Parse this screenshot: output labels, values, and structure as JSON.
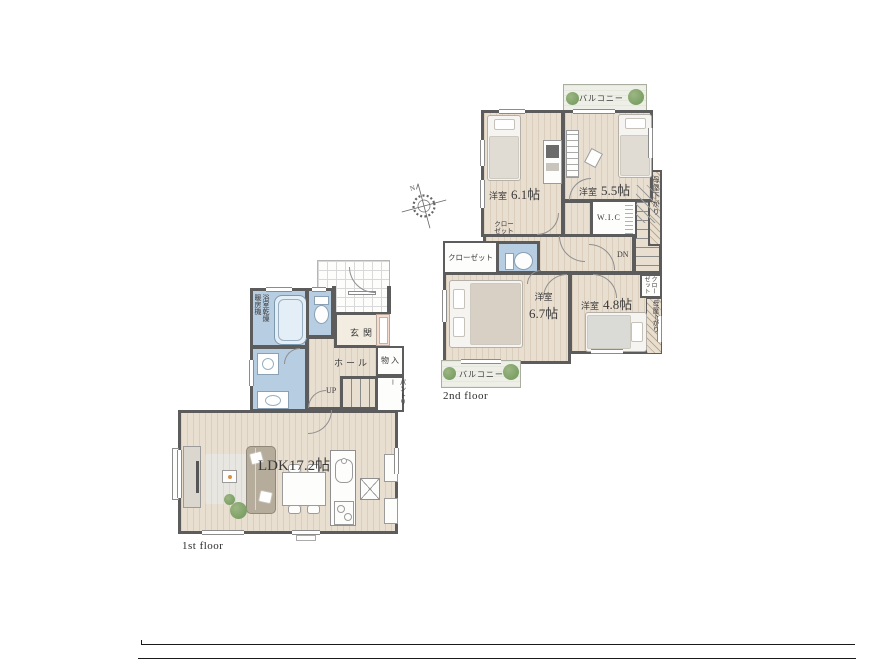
{
  "compass": {
    "north": "N"
  },
  "floor2": {
    "caption": "2nd floor",
    "balcony_top": "バルコニー",
    "balcony_bottom": "バルコニー",
    "bedroom_61_type": "洋室",
    "bedroom_61_size": "6.1帖",
    "bedroom_55_type": "洋室",
    "bedroom_55_size": "5.5帖",
    "bedroom_67_type": "洋室",
    "bedroom_67_size": "6.7帖",
    "bedroom_48_type": "洋室",
    "bedroom_48_size": "4.8帖",
    "wic": "W.I.C",
    "closet_61_line1": "クロー",
    "closet_61_line2": "ゼット",
    "closet_hall": "クローゼット",
    "closet_48_col1": "クロー",
    "closet_48_col2": "ゼット",
    "moya_upper": "母屋下がり",
    "moya_lower": "母屋下がり",
    "stairs_down": "DN"
  },
  "floor1": {
    "caption": "1st floor",
    "ldk": "LDK17.2帖",
    "entrance": "玄関",
    "hall": "ホール",
    "storage": "物入",
    "pantry": "パントリー",
    "stairs_up": "UP",
    "bathroom_dryer_col1": "浴室乾燥",
    "bathroom_dryer_col2": "暖房機"
  },
  "colors": {
    "wall": "#5c5c5c",
    "wood_floor": "#e9dfd1",
    "wet_area": "#b7cde1",
    "tile_line": "#d9d9d9",
    "accent_pink": "#f6dccf",
    "balcony": "#eef0e8",
    "plant": "#7ca065"
  }
}
